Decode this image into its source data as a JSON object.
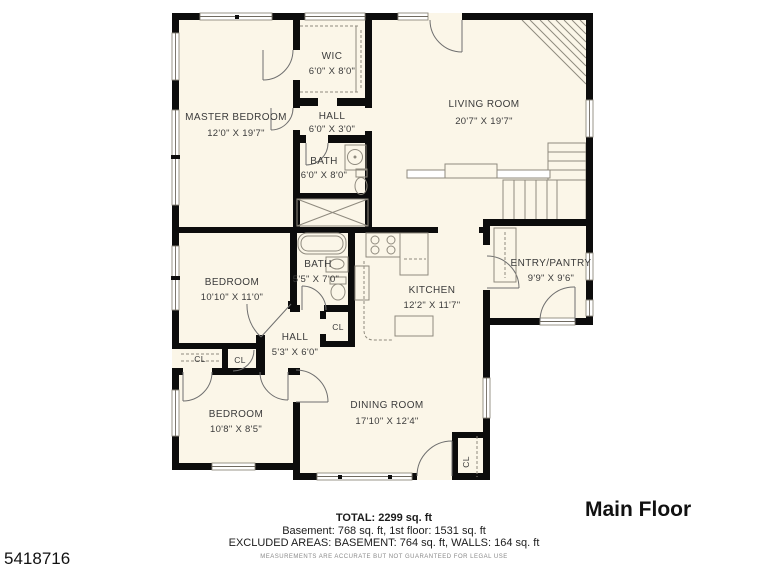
{
  "page": {
    "floor_label": "Main Floor",
    "listing_id": "5418716"
  },
  "plan": {
    "rooms": {
      "master_bedroom": {
        "name": "MASTER BEDROOM",
        "dims": "12'0\" X 19'7\""
      },
      "wic": {
        "name": "WIC",
        "dims": "6'0\" X 8'0\""
      },
      "hall_upper": {
        "name": "HALL",
        "dims": "6'0\" X 3'0\""
      },
      "bath_upper": {
        "name": "BATH",
        "dims": "6'0\" X 8'0\""
      },
      "living_room": {
        "name": "LIVING ROOM",
        "dims": "20'7\" X 19'7\""
      },
      "bedroom_mid": {
        "name": "BEDROOM",
        "dims": "10'10\" X 11'0\""
      },
      "bath_lower": {
        "name": "BATH",
        "dims": "5'5\" X 7'0\""
      },
      "kitchen": {
        "name": "KITCHEN",
        "dims": "12'2\" X 11'7\""
      },
      "entry_pantry": {
        "name": "ENTRY/PANTRY",
        "dims": "9'9\" X 9'6\""
      },
      "hall_lower": {
        "name": "HALL",
        "dims": "5'3\" X 6'0\""
      },
      "bedroom_bottom": {
        "name": "BEDROOM",
        "dims": "10'8\" X 8'5\""
      },
      "dining_room": {
        "name": "DINING ROOM",
        "dims": "17'10\" X 12'4\""
      }
    },
    "closet_label": "CL"
  },
  "footer": {
    "total": "TOTAL: 2299 sq. ft",
    "areas": "Basement: 768 sq. ft, 1st floor: 1531 sq. ft",
    "excluded": "EXCLUDED AREAS: BASEMENT: 764 sq. ft, WALLS: 164 sq. ft",
    "disclaimer": "MEASUREMENTS ARE ACCURATE BUT NOT GUARANTEED FOR LEGAL USE"
  },
  "colors": {
    "floor": "#FBF6E8",
    "wall": "#0c0c0c",
    "thin_line": "#8f8a7e",
    "door_line": "#6f6f6f",
    "text": "#3b3b3b"
  }
}
